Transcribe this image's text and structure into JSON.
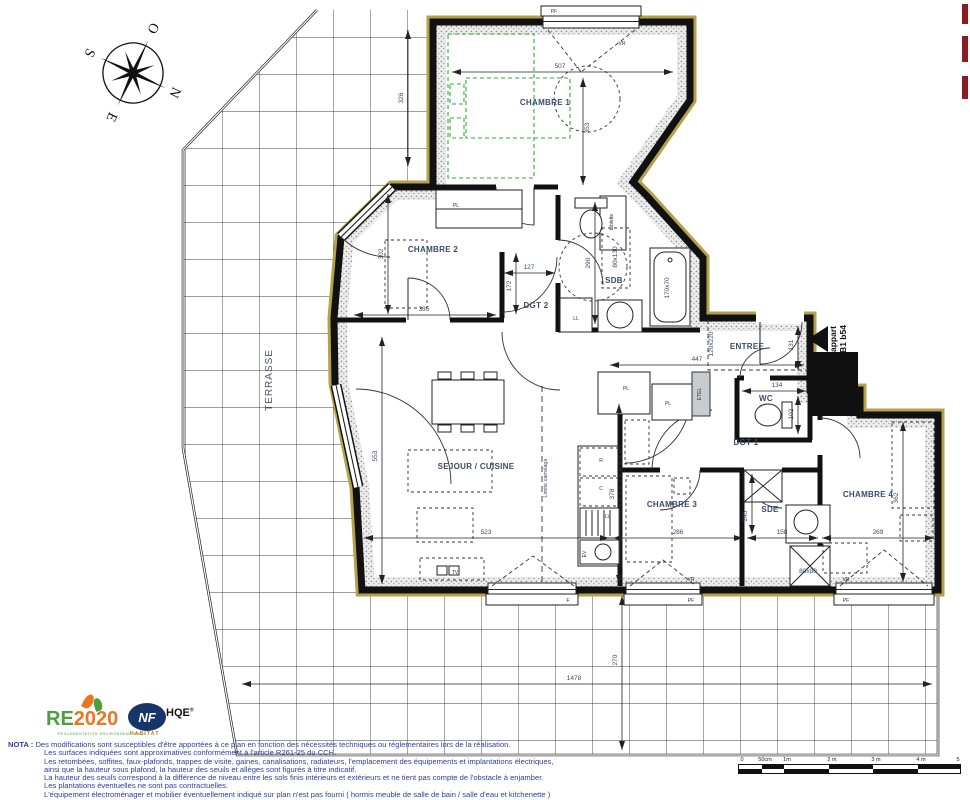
{
  "compass": {
    "north": "N",
    "south": "S",
    "east": "E",
    "west": "O"
  },
  "apartment_tag": {
    "line1": "appart",
    "line2": "B1 b54"
  },
  "rooms": {
    "chambre1": "CHAMBRE 1",
    "chambre2": "CHAMBRE 2",
    "chambre3": "CHAMBRE 3",
    "chambre4": "CHAMBRE 4",
    "sejour": "SEJOUR / CUISINE",
    "sdb": "SDB",
    "sde": "SDE",
    "wc": "WC",
    "entree": "ENTREE",
    "dgt1": "DGT 1",
    "dgt2": "DGT 2",
    "terrasse": "TERRASSE"
  },
  "fixtures": {
    "pf": "PF",
    "vr": "VR",
    "f": "F",
    "pl": "PL",
    "etel": "ETEL",
    "ll": "LL",
    "lv": "LV",
    "ev": "EV",
    "r": "R",
    "c": "C",
    "tv": "TV",
    "tablette": "tablette",
    "limite_carrelage": "Limite carrelage"
  },
  "dims": {
    "ch1_w": "507",
    "ch1_h": "353",
    "terrace_nw": "326",
    "ch2_h": "302",
    "ch2_w": "335",
    "dgt2_w": "127",
    "dgt2_h": "172",
    "sdb_h": "290",
    "sdb_unit": "80x130",
    "bath": "170x70",
    "entry_w": "447",
    "entry_door": "120x220",
    "entree_h": "131",
    "wc_w": "134",
    "wc_h": "102",
    "ch3_h": "378",
    "sejour_w": "523",
    "ch3_w": "286",
    "sde_w": "158",
    "sde_h": "245",
    "ch4_w": "269",
    "ch4_h": "362",
    "sejour_h": "553",
    "shower": "80x80",
    "terrace_s_h": "270",
    "terrace_s_w": "1478"
  },
  "nota": {
    "title": "NOTA :",
    "lines": [
      "Des modifications sont susceptibles d'être apportées à ce plan en fonction des nécessités techniques ou réglementaires lors de la réalisation.",
      "Les surfaces indiquées sont approximatives conformément à l'article R261-25 du CCH.",
      "Les retombées, soffites, faux-plafonds, trappes de visite, gaines, canalisations, radiateurs, l'emplacement des équipements et implantations électriques,",
      "ainsi que la hauteur sous plafond, la hauteur des seuils et allèges sont figurés à titre indicatif.",
      "La hauteur des seuils correspond à la différence de niveau entre les sols finis intérieurs et extérieurs et ne tient pas compte de l'obstacle à enjamber.",
      "Les plantations éventuelles ne sont pas contractuelles.",
      "L'équipement électroménager et mobilier éventuellement indiqué sur plan n'est pas fourni ( hormis meuble de salle de bain / salle d'eau et kitchenette )"
    ]
  },
  "logos": {
    "re2020": {
      "re": "RE",
      "year": "2020",
      "subtitle": "RÉGLEMENTATION ENVIRONNEMENTALE"
    },
    "nfhqe": {
      "nf": "NF",
      "hqe": "HQE",
      "reg": "®",
      "habitat": "HABITAT"
    }
  },
  "scalebar": {
    "ticks": [
      "0",
      "50cm",
      "1m",
      "2 m",
      "3 m",
      "4 m",
      "5 m"
    ]
  }
}
